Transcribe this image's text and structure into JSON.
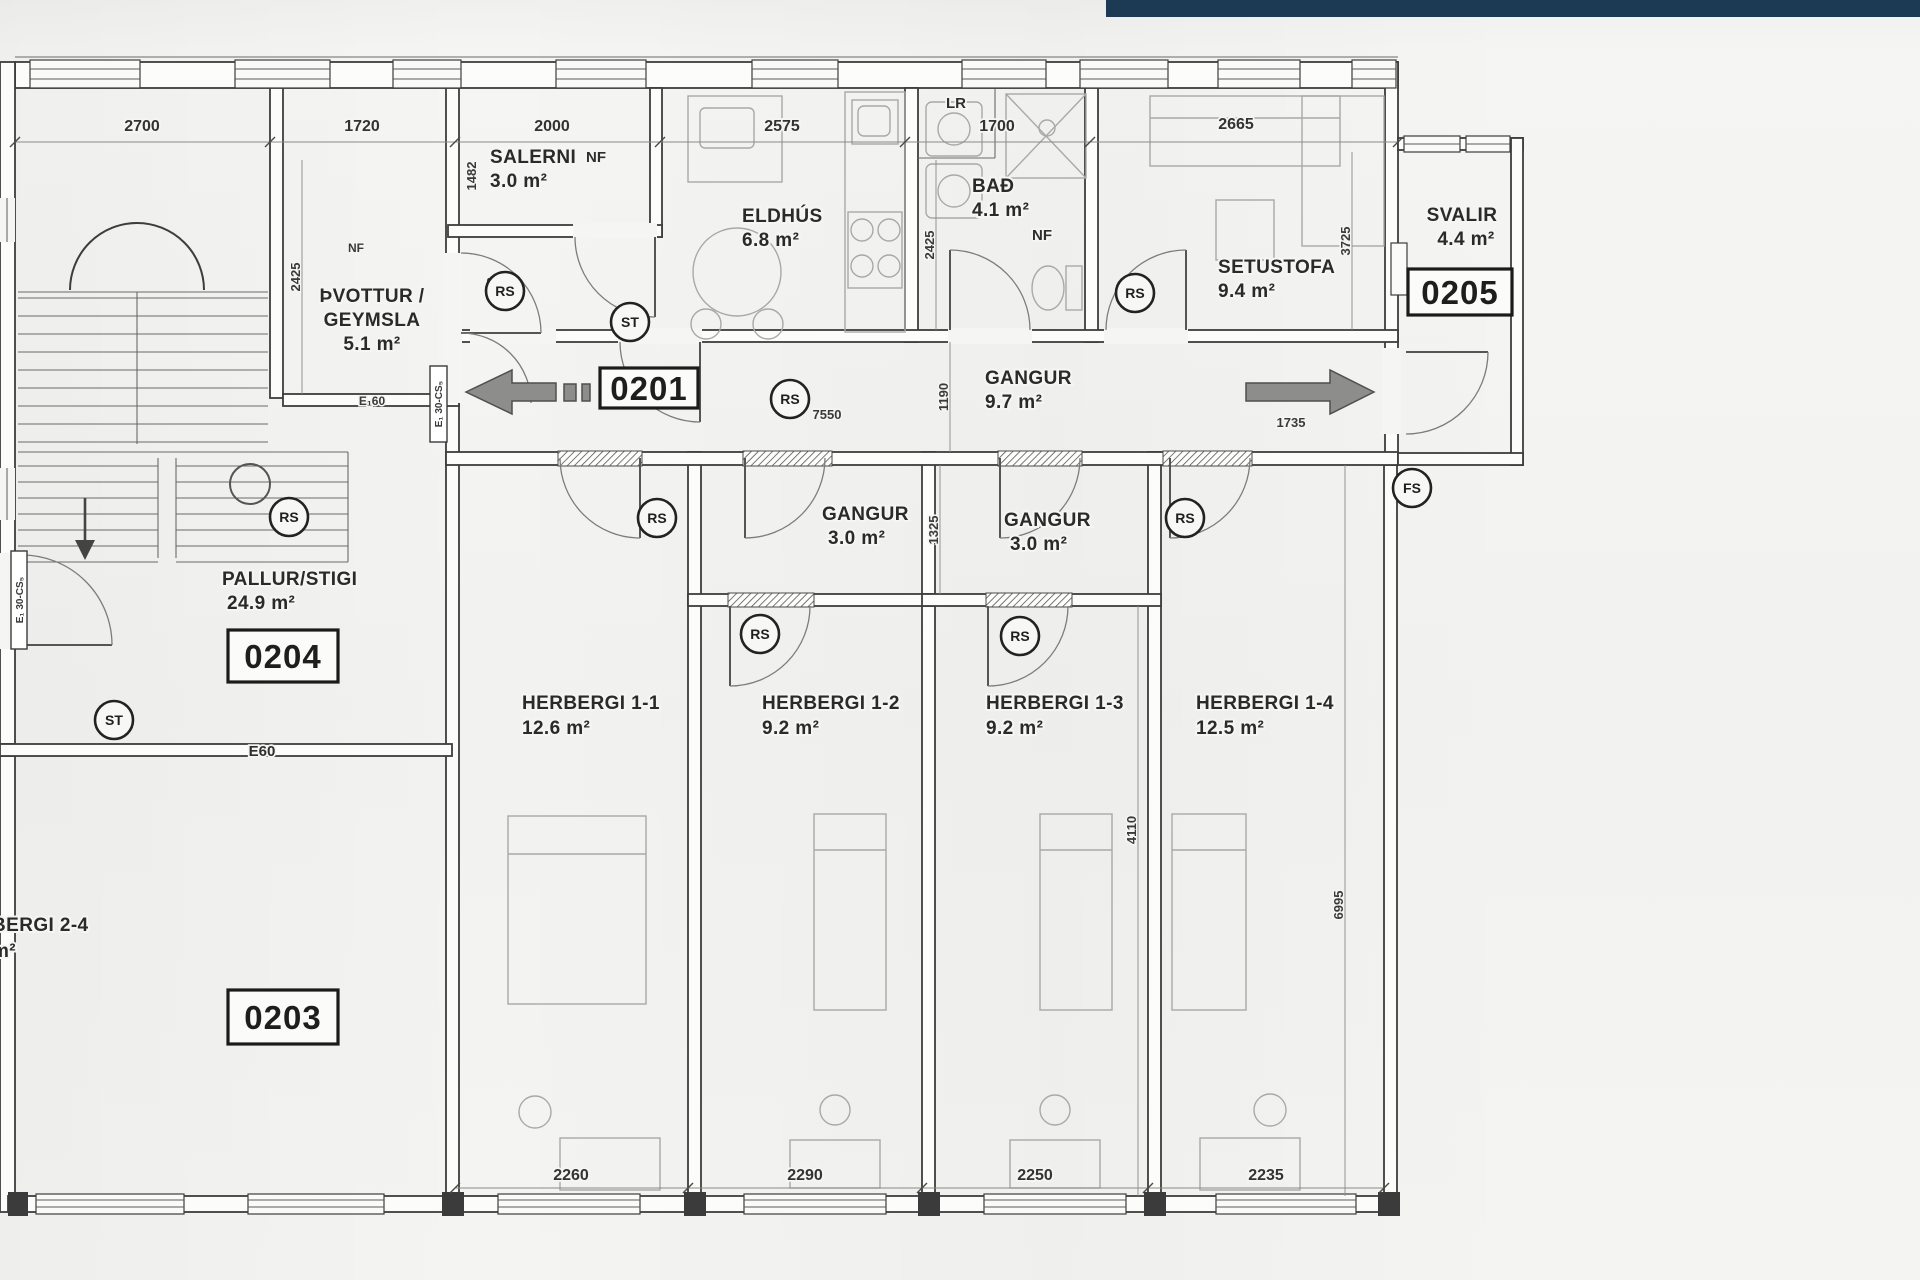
{
  "topbar": {
    "color": "#1d3a55"
  },
  "units": {
    "c0201": "0201",
    "c0203": "0203",
    "c0204": "0204",
    "c0205": "0205"
  },
  "rooms": {
    "pallur": {
      "line1": "PALLUR/STIGI",
      "area": "24.9 m²"
    },
    "thvottur": {
      "line1": "ÞVOTTUR /",
      "line2": "GEYMSLA",
      "area": "5.1 m²"
    },
    "salerni": {
      "line1": "SALERNI",
      "area": "3.0 m²"
    },
    "eldhus": {
      "line1": "ELDHÚS",
      "area": "6.8 m²"
    },
    "bad": {
      "line1": "BAÐ",
      "area": "4.1 m²"
    },
    "setustofa": {
      "line1": "SETUSTOFA",
      "area": "9.4 m²"
    },
    "svalir": {
      "line1": "SVALIR",
      "area": "4.4 m²"
    },
    "gangur": {
      "line1": "GANGUR",
      "area": "9.7 m²"
    },
    "gangur2": {
      "line1": "GANGUR",
      "area": "3.0 m²"
    },
    "gangur3": {
      "line1": "GANGUR",
      "area": "3.0 m²"
    },
    "h11": {
      "line1": "HERBERGI 1-1",
      "area": "12.6 m²"
    },
    "h12": {
      "line1": "HERBERGI 1-2",
      "area": "9.2 m²"
    },
    "h13": {
      "line1": "HERBERGI 1-3",
      "area": "9.2 m²"
    },
    "h14": {
      "line1": "HERBERGI 1-4",
      "area": "12.5 m²"
    },
    "h24": {
      "line1": "BERGI 2-4",
      "area": "m²"
    }
  },
  "tags": {
    "lr": "LR",
    "nf_salerni": "NF",
    "nf_thvottur": "NF",
    "nf_bad": "NF",
    "e160": "E₁60",
    "e60": "E60",
    "fire_left": "E₁ 30-CS₅",
    "fire_corridor": "E₁ 30-CS₅"
  },
  "markers": {
    "rs": "RS",
    "st": "ST",
    "fs": "FS"
  },
  "dims": {
    "d2700": "2700",
    "d1720": "1720",
    "d2000": "2000",
    "d2575": "2575",
    "d1700": "1700",
    "d2665": "2665",
    "d1482": "1482",
    "d2425a": "2425",
    "d2425b": "2425",
    "d843": "843",
    "d3725": "3725",
    "d1190": "1190",
    "d7550": "7550",
    "d1735": "1735",
    "d1325": "1325",
    "d4110": "4110",
    "d6995": "6995",
    "d2260": "2260",
    "d2290": "2290",
    "d2250": "2250",
    "d2235": "2235"
  }
}
